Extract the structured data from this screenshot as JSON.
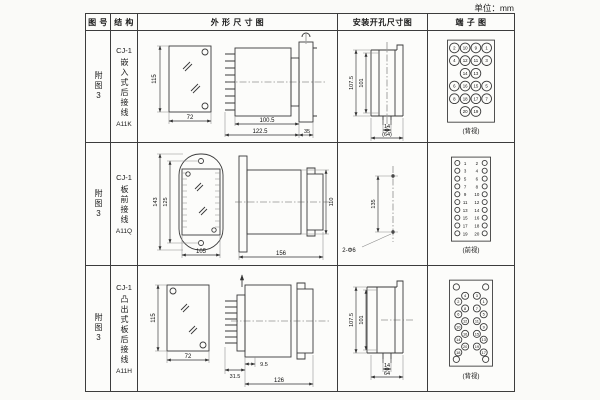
{
  "unit_label": "单位：mm",
  "headers": {
    "fig": "图 号",
    "struct": "结 构",
    "outline": "外 形 尺 寸 图",
    "install": "安装开孔尺寸图",
    "terminal": "端 子 图"
  },
  "rows": [
    {
      "fig": "附图3",
      "model": "CJ-1",
      "structure": "嵌入式后接线",
      "code": "A11K",
      "outline": {
        "h": "115",
        "w": "72",
        "d1": "100.5",
        "d2": "122.5",
        "d3": "35"
      },
      "install": {
        "v1": "107.5",
        "v2": "101",
        "b1": "14",
        "b2": "(64)"
      },
      "terminal": {
        "caption": "(背视)",
        "labels": [
          "2",
          "10",
          "9",
          "1",
          "4",
          "12",
          "11",
          "3",
          "14",
          "13",
          "6",
          "16",
          "15",
          "5",
          "8",
          "18",
          "17",
          "7",
          "20",
          "19"
        ]
      }
    },
    {
      "fig": "附图3",
      "model": "CJ-1",
      "structure": "板前接线",
      "code": "A11Q",
      "outline": {
        "h1": "143",
        "h2": "125",
        "w": "105",
        "len": "156",
        "dia": "110"
      },
      "install": {
        "spacing": "135",
        "holes": "2-Φ6"
      },
      "terminal": {
        "caption": "(前视)",
        "left": [
          "1",
          "3",
          "5",
          "7",
          "9",
          "11",
          "13",
          "15",
          "17",
          "19"
        ],
        "right": [
          "2",
          "4",
          "6",
          "8",
          "10",
          "12",
          "14",
          "16",
          "18",
          "20"
        ]
      }
    },
    {
      "fig": "附图3",
      "model": "CJ-1",
      "structure": "凸出式板后接线",
      "code": "A11H",
      "outline": {
        "h": "115",
        "w": "72",
        "d1": "31.5",
        "d2": "9.5",
        "d3": "126"
      },
      "install": {
        "v1": "107.5",
        "v2": "101",
        "b1": "14",
        "b2": "64"
      },
      "terminal": {
        "caption": "(背视)",
        "labels": [
          "2",
          "4",
          "3",
          "1",
          "6",
          "8",
          "7",
          "5",
          "10",
          "12",
          "11",
          "9",
          "14",
          "16",
          "15",
          "13",
          "18",
          "20",
          "19",
          "17"
        ]
      }
    }
  ]
}
